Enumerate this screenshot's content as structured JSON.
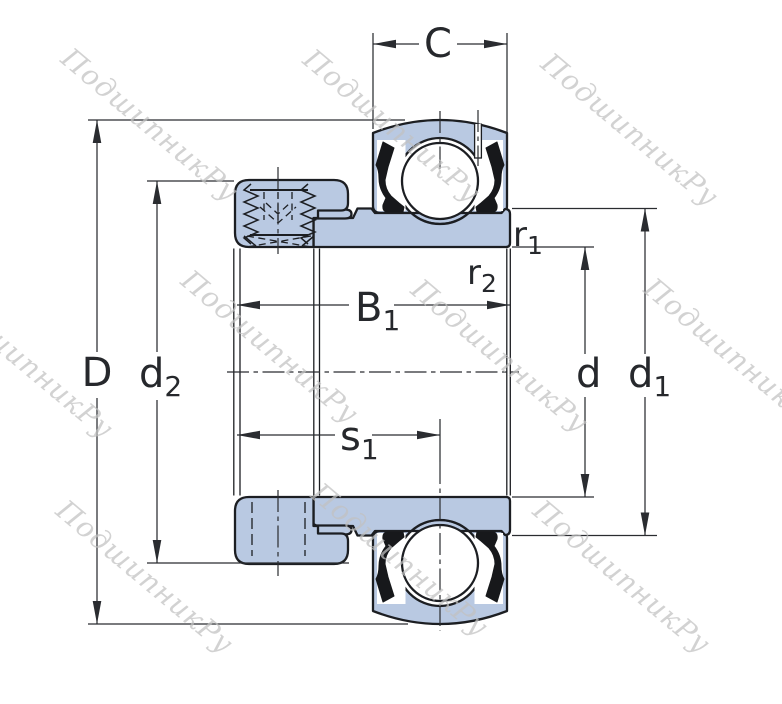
{
  "watermark": {
    "text": "ПодшипникРу"
  },
  "colors": {
    "part_fill": "#b9c9e2",
    "outline": "#1c1e22",
    "dimension_line": "#2a2c30",
    "watermark": "#c2c2c2"
  },
  "dimension_labels": {
    "C": {
      "base": "C",
      "sub": ""
    },
    "D": {
      "base": "D",
      "sub": ""
    },
    "d2": {
      "base": "d",
      "sub": "2"
    },
    "B1": {
      "base": "B",
      "sub": "1"
    },
    "s1": {
      "base": "s",
      "sub": "1"
    },
    "r1": {
      "base": "r",
      "sub": "1"
    },
    "r2": {
      "base": "r",
      "sub": "2"
    },
    "d": {
      "base": "d",
      "sub": ""
    },
    "d1": {
      "base": "d",
      "sub": "1"
    }
  }
}
